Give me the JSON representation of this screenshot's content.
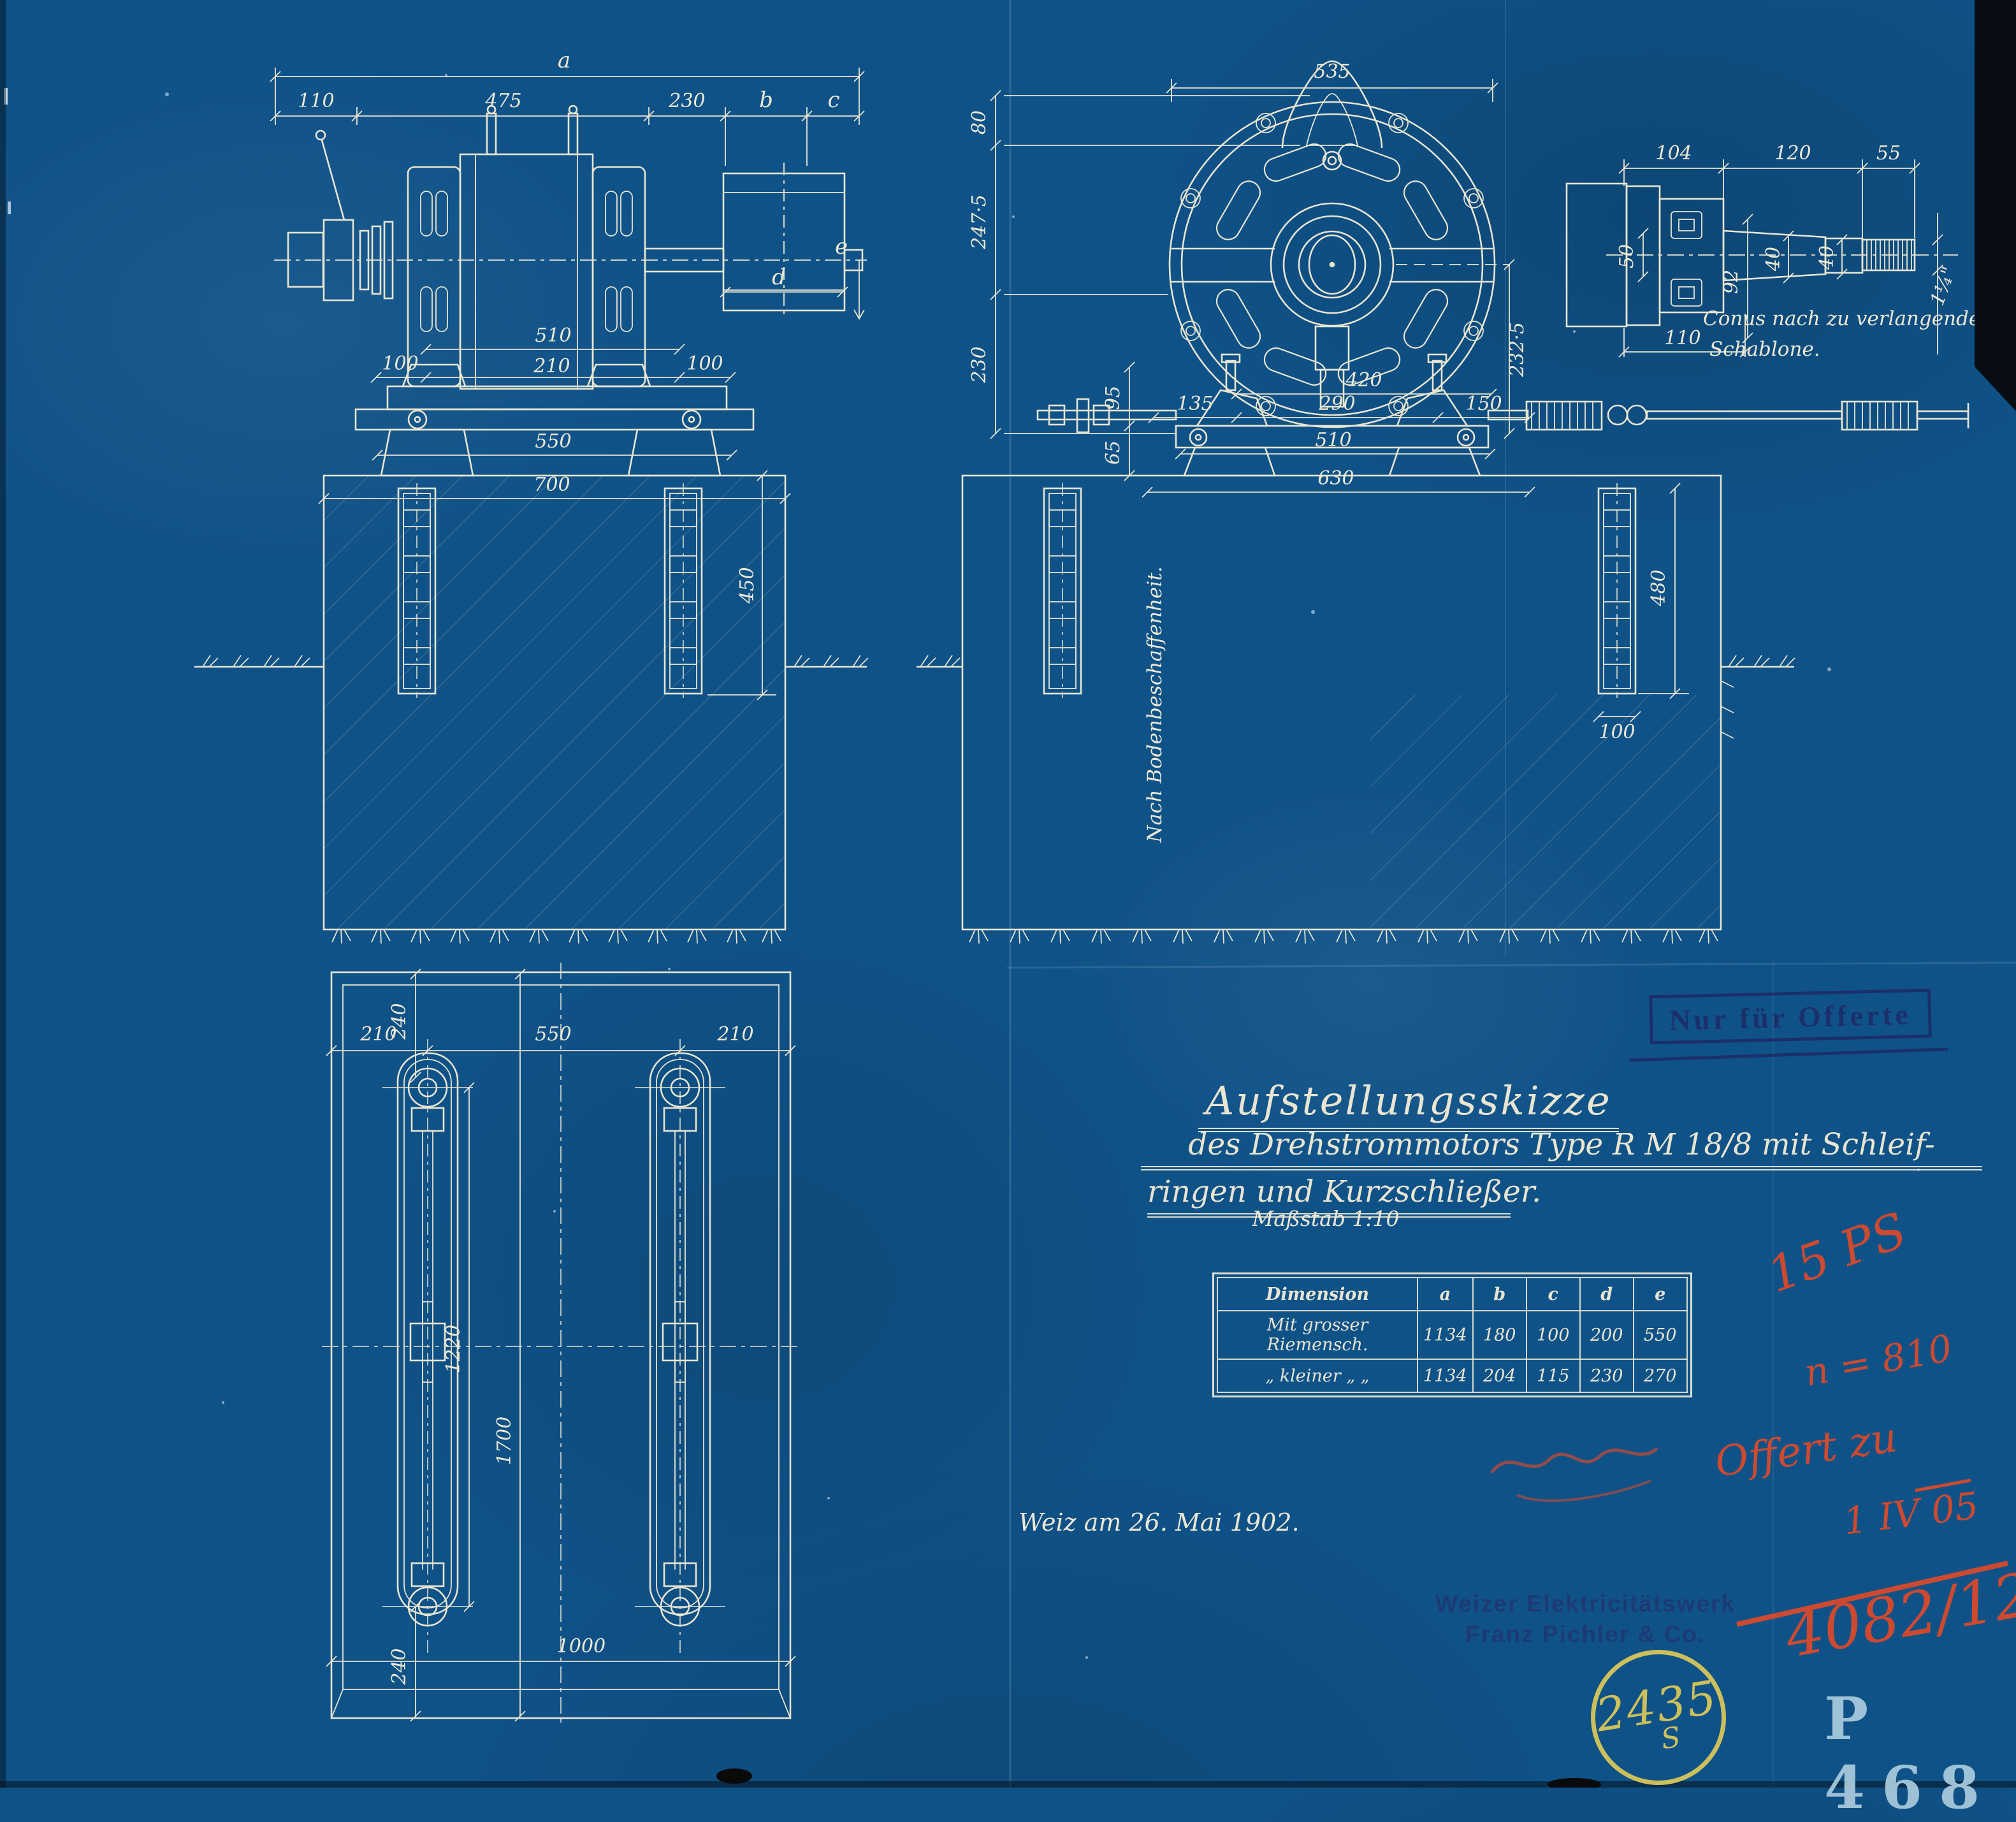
{
  "colors": {
    "paper_blue": "#0f5288",
    "line_ink": "#ece8d4",
    "stamp_navy": "#1c2f6d",
    "annotation_red": "#cd4a30",
    "registry_yellow": "#cdc05c",
    "plate_light_blue": "#a6c8db"
  },
  "header_stamp": {
    "text": "Nur für Offerte"
  },
  "title_block": {
    "line1": "Aufstellungsskizze",
    "line2": "des Drehstrommotors Type R M 18/8 mit Schleif-",
    "line3": "ringen und Kurzschließer.",
    "scale_note": "Maßstab 1:10"
  },
  "dimension_table": {
    "headers": [
      "Dimension",
      "a",
      "b",
      "c",
      "d",
      "e"
    ],
    "rows": [
      {
        "label": "Mit grosser Riemensch.",
        "a": "1134",
        "b": "180",
        "c": "100",
        "d": "200",
        "e": "550"
      },
      {
        "label": "„  kleiner  „  „",
        "a": "1134",
        "b": "204",
        "c": "115",
        "d": "230",
        "e": "270"
      }
    ]
  },
  "date_note": "Weiz am 26. Mai 1902.",
  "maker_stamp": {
    "line1": "Weizer Elektricitätswerk",
    "line2": "Franz Pichler & Co."
  },
  "registry_stamp": {
    "number": "2435",
    "letter": "S"
  },
  "plate_number": "P 468",
  "red_annotations": {
    "power": "15 PS",
    "speed": "n = 810",
    "offer": "Offert zu",
    "date": "1 IV 05",
    "file_number": "4082/12"
  },
  "side_view": {
    "dims": {
      "overall": "a",
      "left": "110",
      "body": "475",
      "gap": "230",
      "pulley_b": "b",
      "pulley_c": "c",
      "pulley_d": "d",
      "pulley_e": "e",
      "rail_510": "510",
      "rail_210": "210",
      "rail_100_left": "100",
      "rail_100_right": "100",
      "bed_550": "550",
      "foundation_700": "700",
      "depth_450": "450"
    }
  },
  "front_view": {
    "dims": {
      "width_535": "535",
      "lug_80": "80",
      "upper_2475": "247·5",
      "lower_230": "230",
      "center_2325": "232·5",
      "feet_420": "420",
      "left_135": "135",
      "mid_290": "290",
      "right_150": "150",
      "bed_510": "510",
      "foundation_630": "630",
      "plate_95": "95",
      "plate_65": "65",
      "anchor_480": "480",
      "channel_100": "100"
    },
    "foundation_note": "Nach Bodenbeschaffenheit."
  },
  "shaft_detail": {
    "dims": {
      "hub_104": "104",
      "cone_120": "120",
      "thread_55": "55",
      "bore_50": "50",
      "hub_92": "92",
      "cone_40": "40",
      "step_40": "40",
      "flange_110": "110",
      "thread_dia": "1¼\""
    },
    "caption_line1": "Conus nach zu verlangenden",
    "caption_line2": "Schablone."
  },
  "plan_view": {
    "dims": {
      "left_210": "210",
      "top_240": "240",
      "center_550": "550",
      "right_210": "210",
      "bolt_1220": "1220",
      "overall_1700": "1700",
      "width_1000": "1000",
      "bottom_240": "240"
    }
  }
}
